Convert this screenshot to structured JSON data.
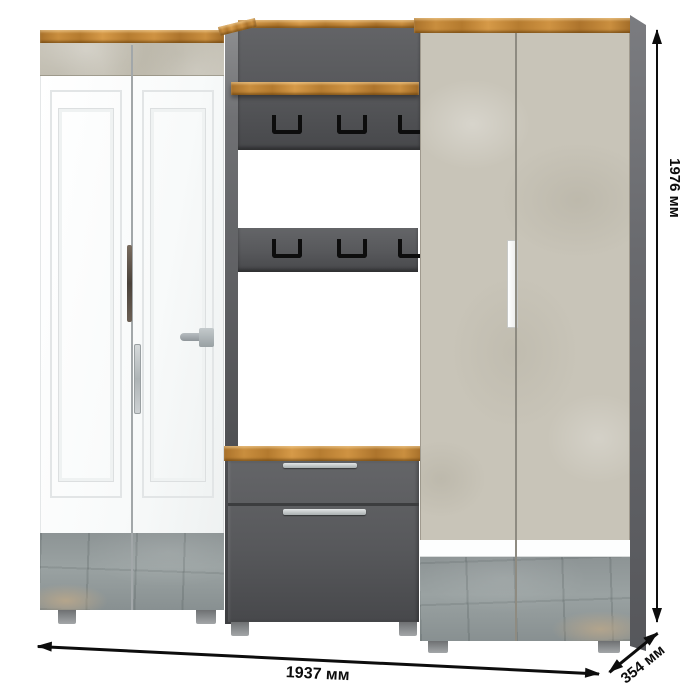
{
  "title": "Hallway furniture set product render with dimensions",
  "annotations": {
    "height_label": "1976 мм",
    "width_label": "1937 мм",
    "depth_label": "354 мм"
  },
  "palette": {
    "wood": "#c08433",
    "wood-dark": "#8a5a1e",
    "concrete": "#c8c4b8",
    "graphite": "#57585b",
    "wall-dark": "#4a4b4e",
    "white-door": "#fbfcfd",
    "mirror": "#98a0a0",
    "metal": "#c3c6c8",
    "ink": "#0d0d0d"
  },
  "furniture": {
    "left_wardrobe": {
      "doors": 2,
      "mirror_inserts": 2,
      "handles": [
        "long-bar-dark",
        "long-bar-silver",
        "lever"
      ]
    },
    "open_section": {
      "shelves": 1,
      "hook_rows": 2,
      "hooks_per_row": 3,
      "drawers": 2
    },
    "right_wardrobe": {
      "doors": 2,
      "mirror_inserts": 2,
      "handles": [
        "recessed-vertical-white"
      ]
    }
  }
}
